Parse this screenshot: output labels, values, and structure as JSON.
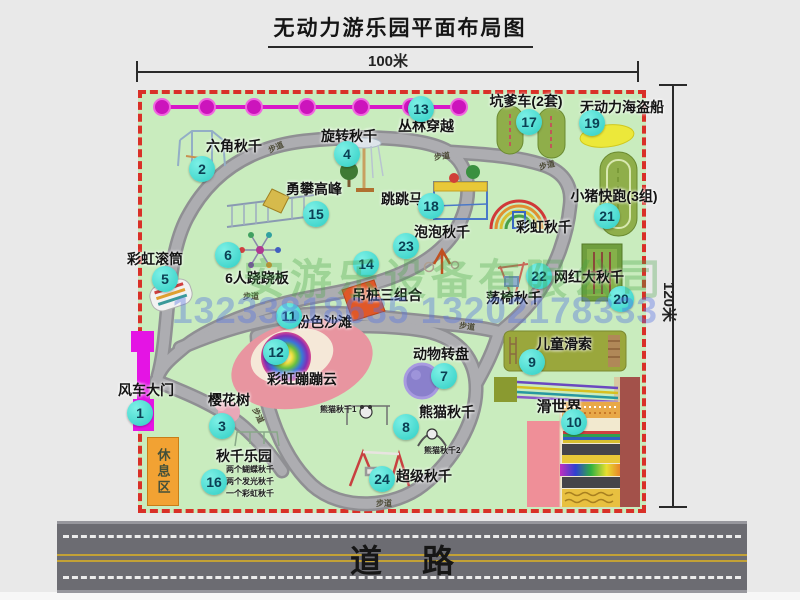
{
  "title": "无动力游乐园平面布局图",
  "dims": {
    "width_label": "100米",
    "height_label": "120米"
  },
  "road": {
    "label": "道路"
  },
  "rest_area": {
    "label": "休息区"
  },
  "walkway_label": "步道",
  "watermark": {
    "company": "安游乐设备有限公司",
    "phones": "13233818635 13202178333"
  },
  "attractions": [
    {
      "num": "1",
      "name": "风车大门"
    },
    {
      "num": "2",
      "name": "六角秋千"
    },
    {
      "num": "3",
      "name": "樱花树"
    },
    {
      "num": "4",
      "name": "旋转秋千"
    },
    {
      "num": "5",
      "name": "彩虹滚筒"
    },
    {
      "num": "6",
      "name": "6人跷跷板"
    },
    {
      "num": "7",
      "name": "动物转盘"
    },
    {
      "num": "8",
      "name": "熊猫秋千"
    },
    {
      "num": "9",
      "name": "儿童滑索"
    },
    {
      "num": "10",
      "name": "滑世界"
    },
    {
      "num": "11",
      "name": "粉色沙滩"
    },
    {
      "num": "12",
      "name": "彩虹蹦蹦云"
    },
    {
      "num": "13",
      "name": "丛林穿越"
    },
    {
      "num": "14",
      "name": "吊桩三组合"
    },
    {
      "num": "15",
      "name": "勇攀高峰"
    },
    {
      "num": "16",
      "name": "秋千乐园"
    },
    {
      "num": "17",
      "name": "坑爹车(2套)"
    },
    {
      "num": "18",
      "name": "跳跳马"
    },
    {
      "num": "19",
      "name": "无动力海盗船"
    },
    {
      "num": "20",
      "name": "网红大秋千"
    },
    {
      "num": "21",
      "name": "小猪快跑(3组)"
    },
    {
      "num": "22",
      "name": "荡椅秋千"
    },
    {
      "num": "23",
      "name": "泡泡秋千"
    },
    {
      "num": "24",
      "name": "超级秋千"
    }
  ],
  "extra": {
    "rainbow_swing": "彩虹秋千",
    "panda1": "熊猫秋千1",
    "panda2": "熊猫秋千2",
    "swing_notes": [
      "两个蝴蝶秋千",
      "两个发光秋千",
      "一个彩虹秋千"
    ]
  },
  "colors": {
    "map_green": "#c9ecbe",
    "border_red": "#d93028",
    "badge_cyan": "#2ecec4",
    "gate_magenta": "#e414e4",
    "zipline_magenta": "#d818c8",
    "road_gray": "#6c6c72",
    "rest_orange": "#f2a233"
  }
}
